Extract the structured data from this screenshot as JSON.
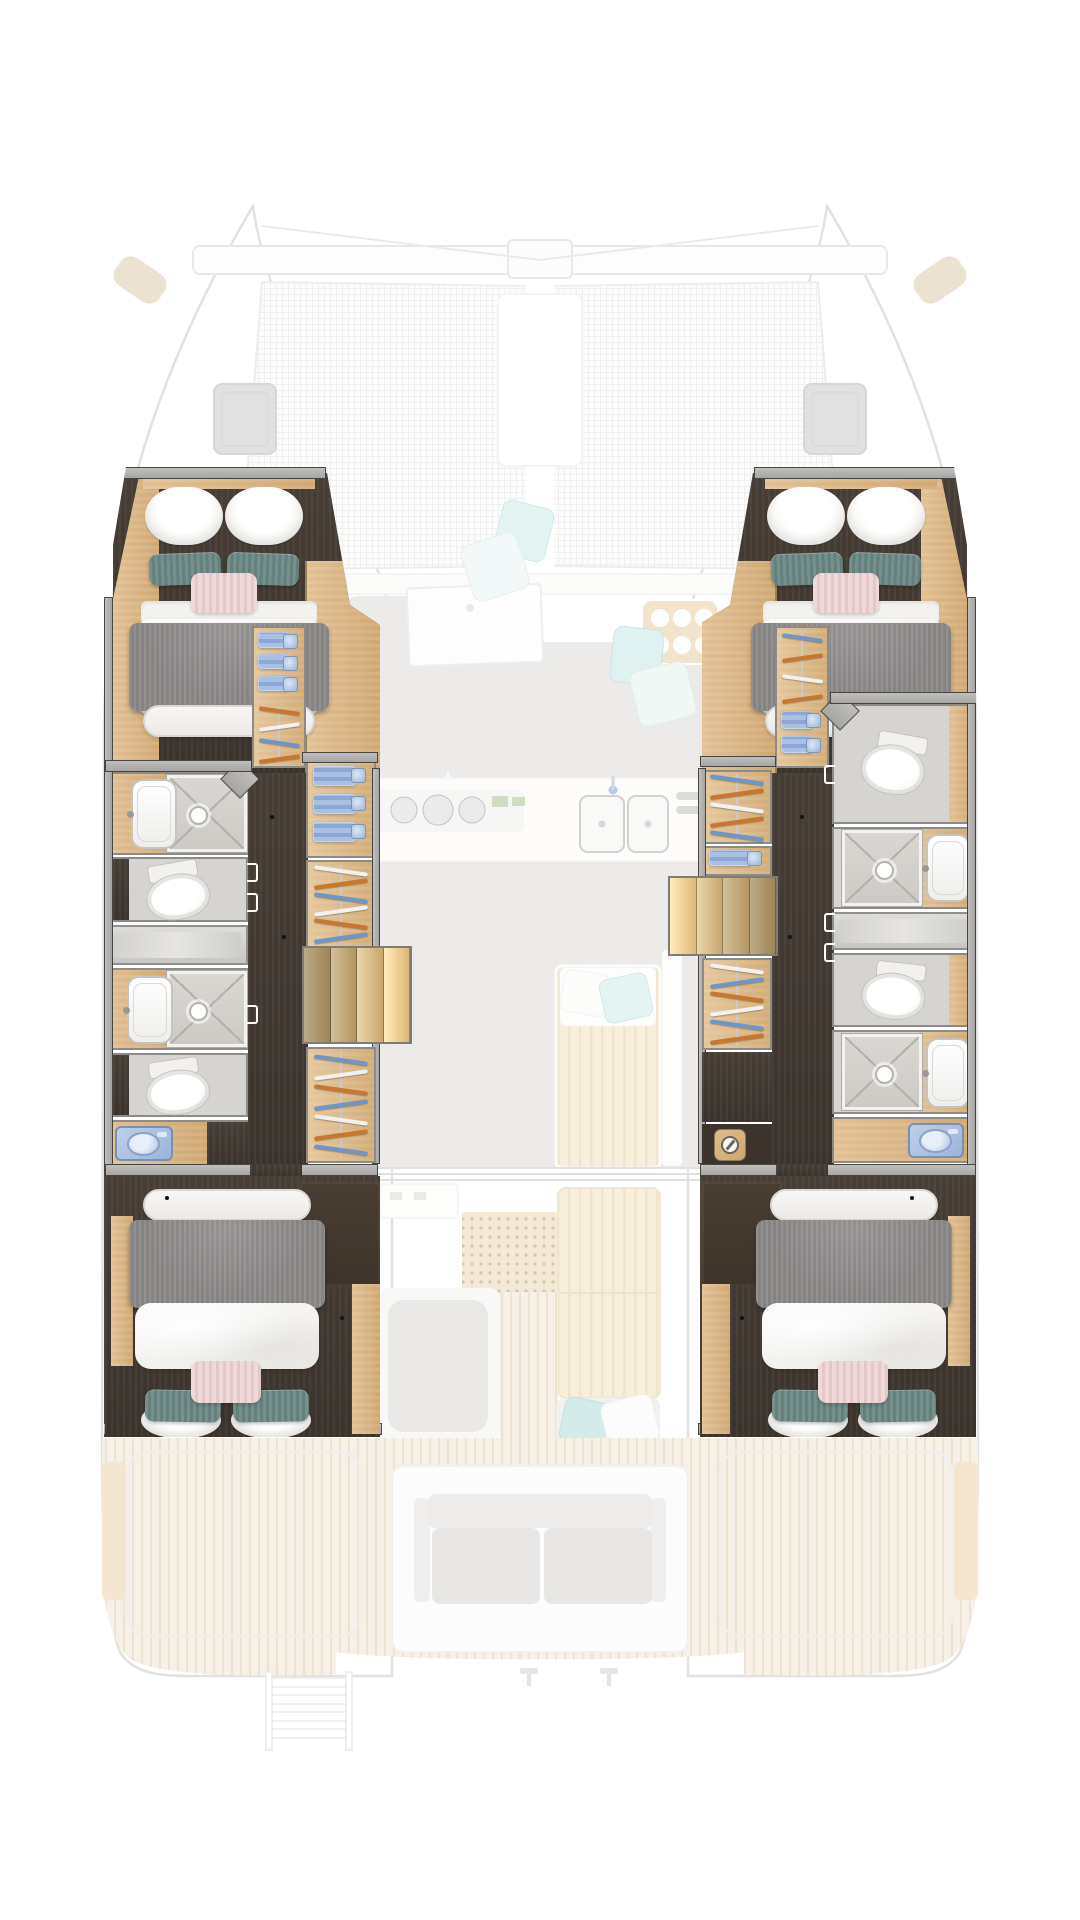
{
  "boat": {
    "type": "catamaran",
    "view": "top-down interior floor plan",
    "sharp_layer": "hull accommodation deck",
    "ghost_layer": "main deck (faded)"
  },
  "palette": {
    "frame_edge": "#47453f",
    "frame_fill": "#b0aeac",
    "dark_floor": "#41382f",
    "oak_light": "#e2c095",
    "oak_dark": "#d0a873",
    "fixture_white": "#fcfcfb",
    "shower_tile": "#d4d1cd",
    "glass_gray": "#cfcecb",
    "towel_blue": "#9ab3de",
    "washer_blue": "#aac1e5",
    "hanger_orange": "#c8772f",
    "hanger_blue": "#6f96c8",
    "hanger_white": "#f1f1ef",
    "blanket_gray": "#8d8b88",
    "pillow_teal": "#6a8583",
    "pillow_pink": "#e9d0cf",
    "aqua_pillow": "#c3e6e3",
    "teak_deck": "#eee3d0",
    "net_line": "#e2e2e0"
  },
  "deck": {
    "trampoline": {
      "panels": 2,
      "crossbeam": true,
      "bridle_lines": 2
    },
    "bow_hatches": 2,
    "forward_cockpit": {
      "cushion_sections": 2,
      "aqua_pillows": 4,
      "deck_door": 1,
      "cup_tray_cups": 6
    },
    "galley": {
      "burners_small": 4,
      "burners_large": 3,
      "green_knobs": 2,
      "sink_basins": 2,
      "faucet": 1,
      "vent_slats": 2
    },
    "saloon": {
      "daybed_pillows": [
        "white",
        "aqua"
      ],
      "partition": 1,
      "slider_tracks": 3,
      "vent_grille": 1,
      "table": 1,
      "bench_pillows": [
        "aqua",
        "white"
      ]
    },
    "aft_cockpit": {
      "sofa_seats": 2,
      "side_bench_outlines": 2,
      "side_boards": 2,
      "transom_ladder_rungs": 4,
      "cleats": 2
    }
  },
  "hulls": {
    "port": {
      "forward_cabin": {
        "bed": {
          "pillows_white": 2,
          "pillows_teal": 2,
          "pillow_pink": 1,
          "duvet": "white",
          "blanket": "gray",
          "foot_bench": "white"
        }
      },
      "forward_wardrobe": {
        "towels": 3,
        "hangers": [
          "orange",
          "white",
          "blue",
          "orange"
        ]
      },
      "washrooms": [
        "forward-shower-room",
        "forward-toilet-room",
        "glass-partition",
        "aft-shower-room",
        "aft-toilet-room"
      ],
      "laundry": {
        "appliance": "washer"
      },
      "midship_wardrobe": {
        "towels": 3,
        "hangers": [
          "white",
          "orange",
          "blue",
          "white",
          "orange",
          "blue"
        ]
      },
      "stairs": {
        "treads": 4
      },
      "aft_wardrobe": {
        "hangers": [
          "blue",
          "white",
          "orange",
          "blue",
          "white",
          "orange",
          "blue"
        ]
      },
      "aft_cabin": {
        "bed": {
          "pillows_white": 2,
          "pillows_teal": 2,
          "pillow_pink": 1,
          "duvet": "white",
          "blanket": "gray",
          "foot_bench": "white"
        }
      }
    },
    "starboard": {
      "forward_cabin": {
        "bed": {
          "pillows_white": 2,
          "pillows_teal": 2,
          "pillow_pink": 1,
          "duvet": "white",
          "blanket": "gray",
          "foot_bench": "white"
        }
      },
      "forward_wardrobe": {
        "towels": 2,
        "hangers": [
          "blue",
          "orange",
          "white",
          "orange"
        ]
      },
      "washrooms": [
        "forward-toilet-room",
        "mid-shower-room",
        "glass-partition",
        "aft-toilet-room",
        "aft-shower-room"
      ],
      "laundry": {
        "appliance": "washer"
      },
      "midship_wardrobe": {
        "hangers": [
          "blue",
          "orange",
          "white",
          "orange",
          "blue"
        ]
      },
      "towel_cubby": {
        "towels": 1
      },
      "stairs": {
        "treads": 4
      },
      "aft_wardrobe": {
        "hangers": [
          "white",
          "blue",
          "orange",
          "white",
          "blue",
          "orange"
        ]
      },
      "utility_icon": "appliance-dial-icon",
      "aft_cabin": {
        "bed": {
          "pillows_white": 2,
          "pillows_teal": 2,
          "pillow_pink": 1,
          "duvet": "white",
          "blanket": "gray",
          "foot_bench": "white"
        }
      }
    }
  }
}
